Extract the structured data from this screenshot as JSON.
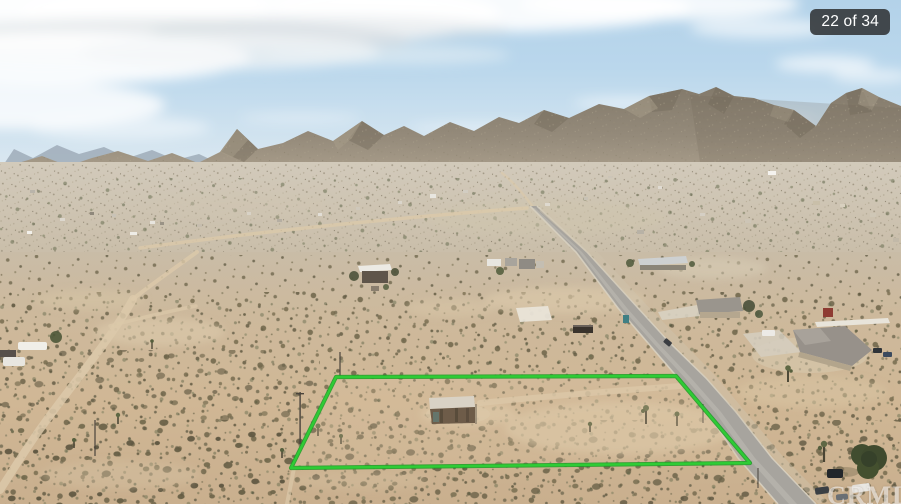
{
  "photo_viewer": {
    "counter_badge": "22 of 34",
    "watermark": "CRMLS",
    "photo_alt": "Aerial drone photo of a flat desert parcel outlined in green, with a small shed and Joshua trees inside the lot, a paved road running along its right edge, scattered homes in the valley and rocky mountains beneath a partly cloudy blue sky"
  },
  "colors": {
    "boundary_green": "#2ecc35",
    "boundary_green_dark": "#1a9b23",
    "badge_bg": "rgba(56,60,64,0.93)",
    "badge_text": "#ffffff",
    "watermark_text": "rgba(255,255,255,0.55)",
    "sky_top": "#b3d2e9",
    "sky_horizon": "#e6edf1",
    "sand": "#cdb596",
    "road_gray": "#a7a49e",
    "mountain": "#8d8374"
  }
}
